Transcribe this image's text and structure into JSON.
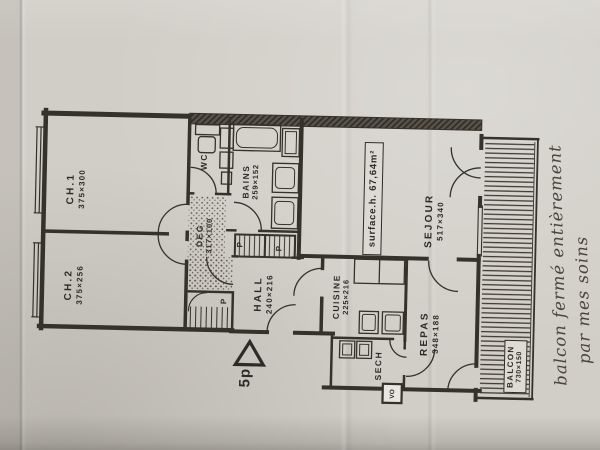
{
  "photo": {
    "paper_color": "#d1cec7",
    "ink_color": "#2e2b26"
  },
  "plan": {
    "type_label": "5p",
    "surface_label": "surface.h. 67,64m²",
    "rooms": [
      {
        "name": "CH.1",
        "dims": "375×300"
      },
      {
        "name": "CH.2",
        "dims": "375×256"
      },
      {
        "name": "WC",
        "dims": ""
      },
      {
        "name": "BAINS",
        "dims": "259×152"
      },
      {
        "name": "DEG",
        "dims": "317×100"
      },
      {
        "name": "HALL",
        "dims": "240×216"
      },
      {
        "name": "CUISINE",
        "dims": "225×216"
      },
      {
        "name": "SEJOUR",
        "dims": "517×340"
      },
      {
        "name": "REPAS",
        "dims": "348×188"
      },
      {
        "name": "SECH",
        "dims": ""
      },
      {
        "name": "BALCON",
        "dims": "730×150"
      }
    ],
    "closet_labels": [
      "P",
      "P",
      "P"
    ],
    "chute_label": "VO"
  },
  "handwriting": {
    "line1": "balcon fermé entièrement",
    "line2": "par mes soins"
  }
}
